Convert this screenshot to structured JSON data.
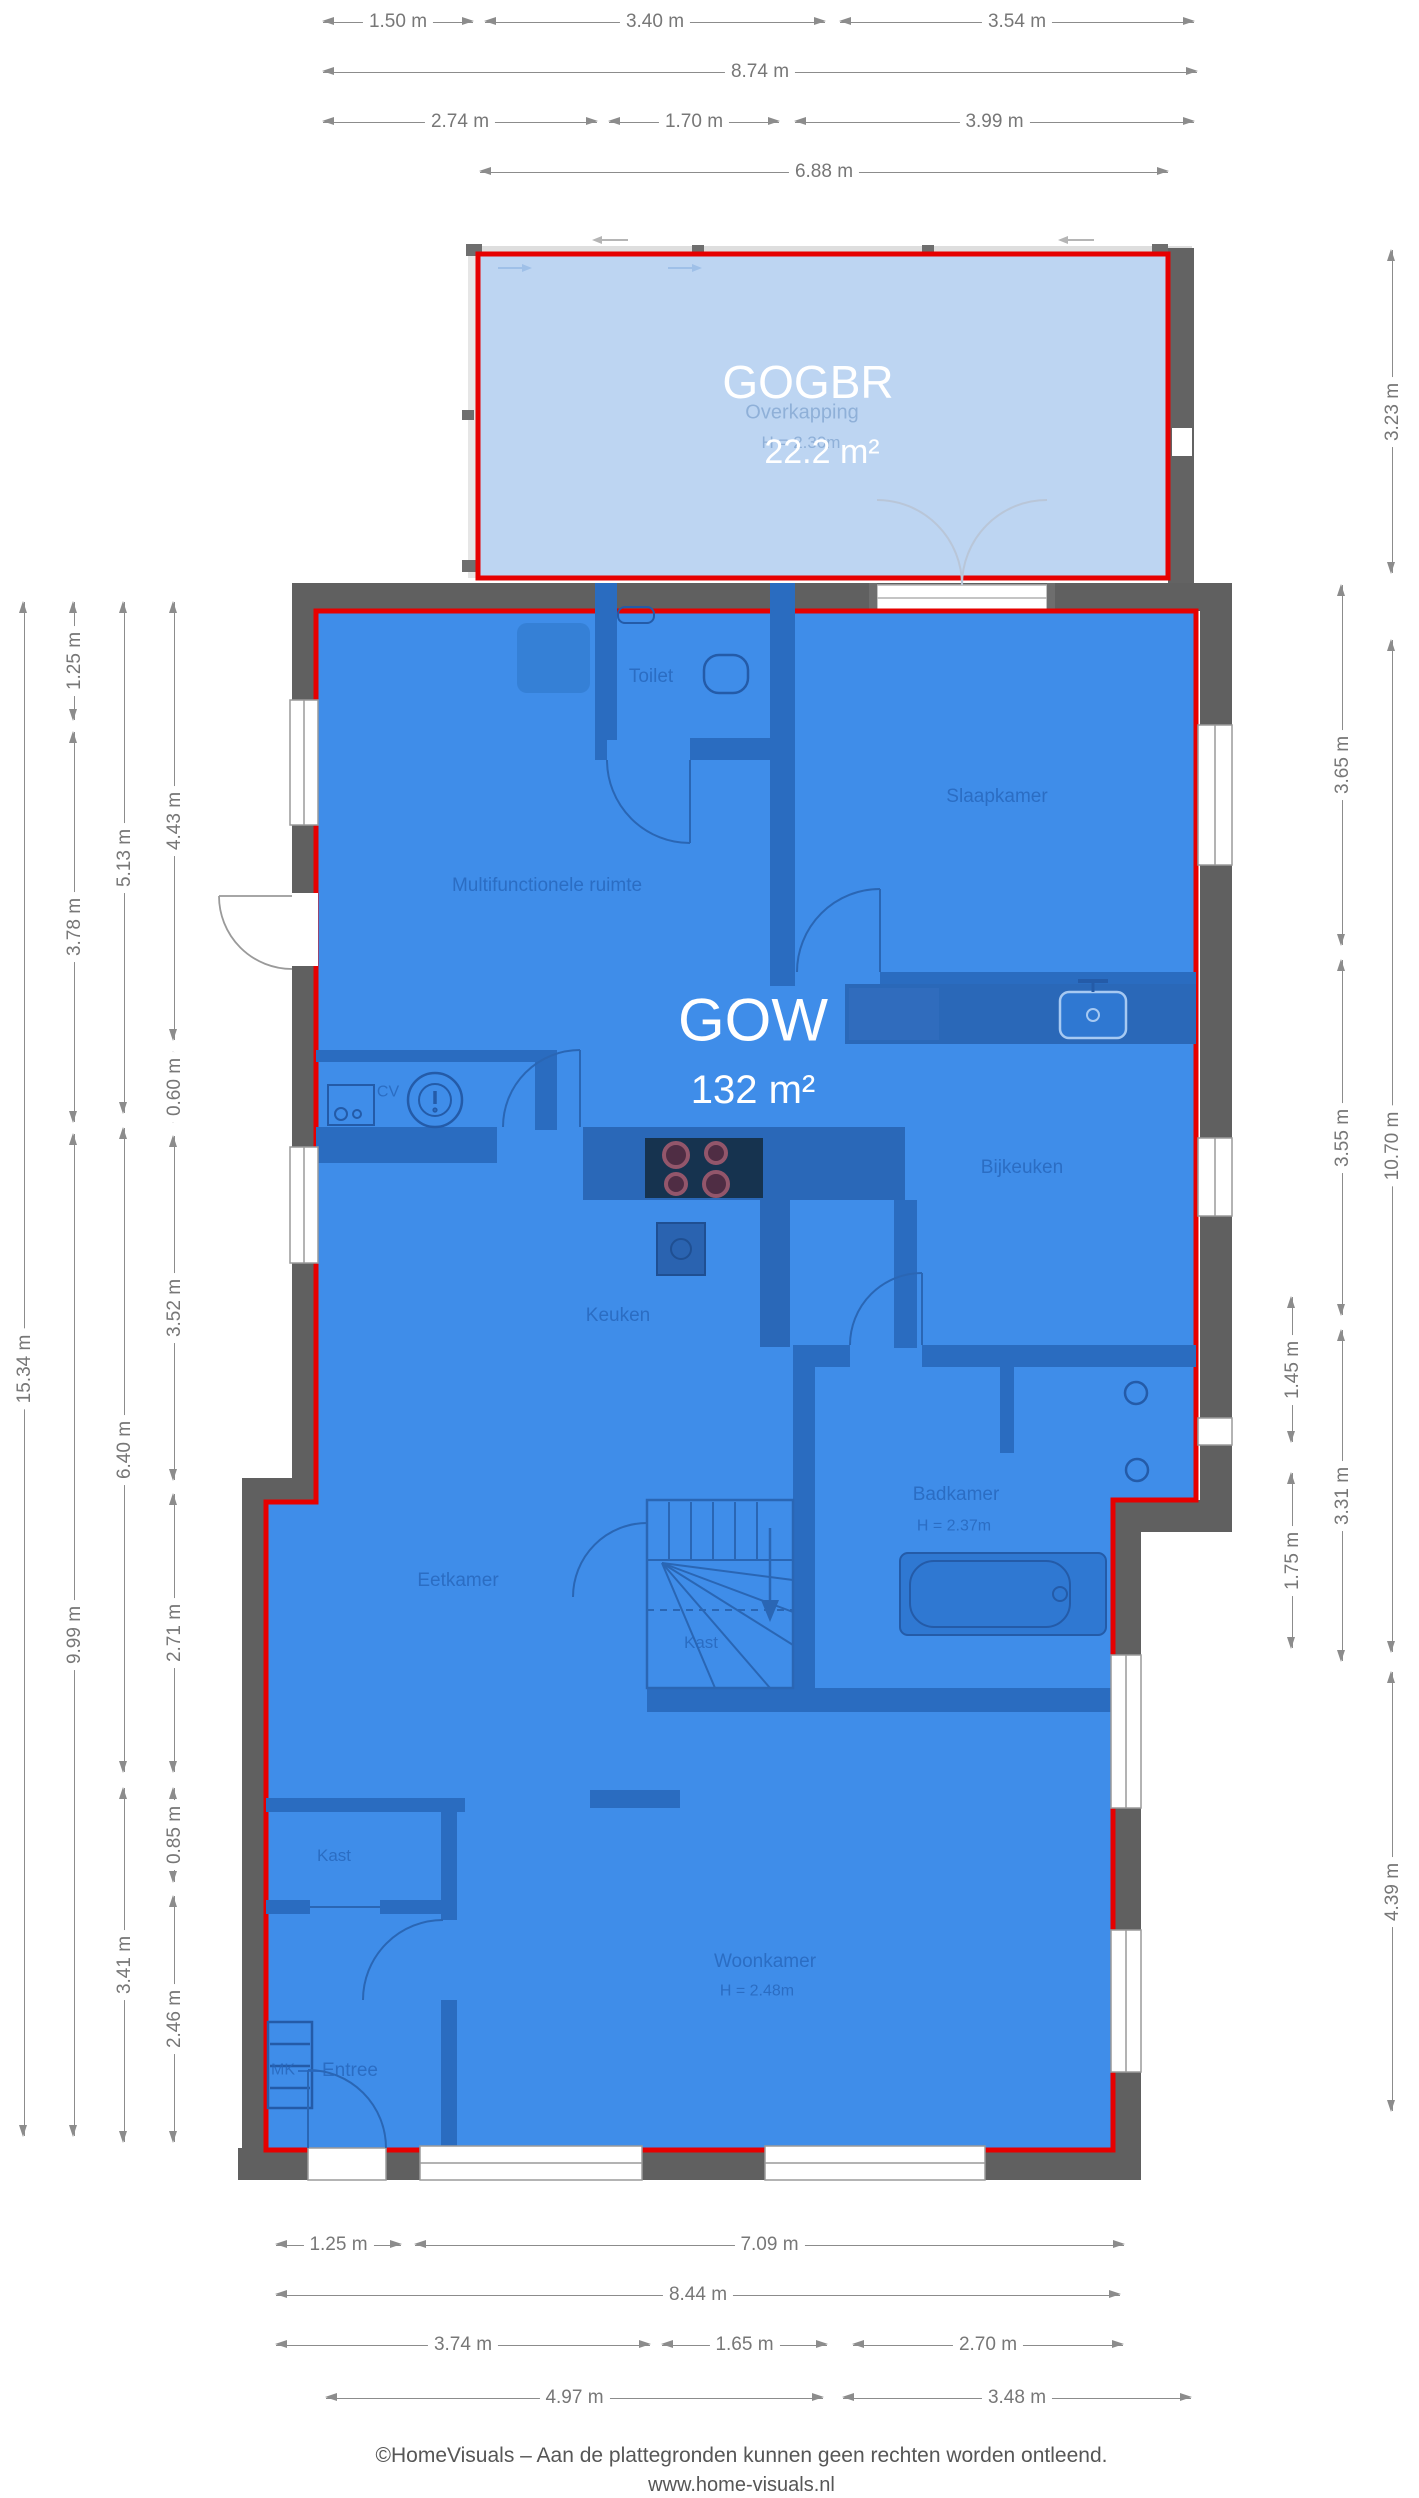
{
  "regions": {
    "gogbr": {
      "code": "GOGBR",
      "area": "22.2 m²",
      "underlying_label": "Overkapping",
      "underlying_height": "H = 2.30m"
    },
    "gow": {
      "code": "GOW",
      "area": "132 m²"
    }
  },
  "rooms": [
    {
      "label": "Toilet"
    },
    {
      "label": "Slaapkamer"
    },
    {
      "label": "Multifunctionele ruimte"
    },
    {
      "label": "CV"
    },
    {
      "label": "Bijkeuken"
    },
    {
      "label": "Keuken"
    },
    {
      "label": "Badkamer",
      "sub": "H = 2.37m"
    },
    {
      "label": "Eetkamer"
    },
    {
      "label": "Kast"
    },
    {
      "label": "Kast"
    },
    {
      "label": "MK"
    },
    {
      "label": "Entree"
    },
    {
      "label": "Woonkamer",
      "sub": "H = 2.48m"
    }
  ],
  "dimensions": {
    "top": [
      "1.50 m",
      "3.40 m",
      "3.54 m",
      "8.74 m",
      "2.74 m",
      "1.70 m",
      "3.99 m",
      "6.88 m"
    ],
    "left": [
      "15.34 m",
      "1.25 m",
      "3.78 m",
      "9.99 m",
      "5.13 m",
      "6.40 m",
      "3.41 m",
      "4.43 m",
      "0.60 m",
      "3.52 m",
      "2.71 m",
      "0.85 m",
      "2.46 m"
    ],
    "right": [
      "3.23 m",
      "10.70 m",
      "4.39 m",
      "3.65 m",
      "3.55 m",
      "3.31 m",
      "1.45 m",
      "1.75 m"
    ],
    "bottom": [
      "1.25 m",
      "7.09 m",
      "8.44 m",
      "3.74 m",
      "1.65 m",
      "2.70 m",
      "4.97 m",
      "3.48 m"
    ]
  },
  "footer": {
    "line1": "©HomeVisuals – Aan de plattegronden kunnen geen rechten worden ontleend.",
    "line2": "www.home-visuals.nl"
  },
  "colors": {
    "overlay_main": "#3f8de9",
    "overlay_secondary": "#bdd5f2",
    "outline_red": "#e60000",
    "wall_gray": "#606060",
    "room_text": "#2766bb",
    "dim_text": "#777777"
  }
}
